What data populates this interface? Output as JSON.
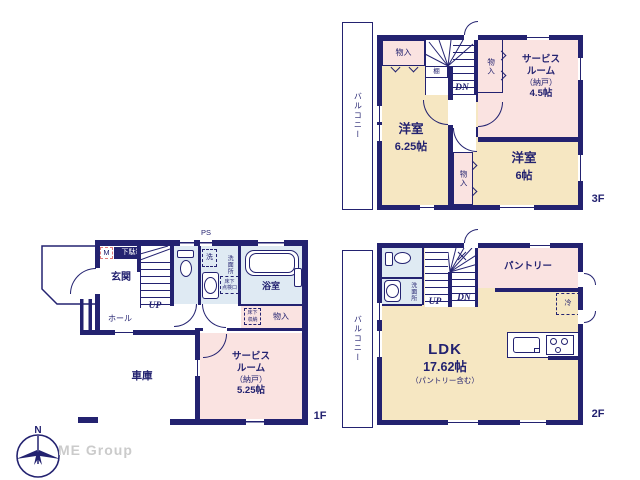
{
  "colors": {
    "wall_navy": "#232270",
    "room_cream": "#f6e7c2",
    "room_pink": "#fae3e1",
    "room_blue": "#dfeaf3",
    "watermark_gray": "#cbcbcb"
  },
  "watermark": "ME Group",
  "compass": {
    "north": "N"
  },
  "f3": {
    "tag": "3F",
    "balcony": "バルコニー",
    "closet_top": "物入",
    "shelf": "棚",
    "closet_mid": "物入",
    "closet_bottom": "物入",
    "dn": "DN",
    "service_room": {
      "line1": "サービス",
      "line2": "ルーム",
      "line3": "（納戸）",
      "line4": "4.5帖"
    },
    "room_a": {
      "name": "洋室",
      "size": "6.25帖"
    },
    "room_b": {
      "name": "洋室",
      "size": "6帖"
    }
  },
  "f2": {
    "tag": "2F",
    "balcony": "バルコニー",
    "washroom": "洗面所",
    "up": "UP",
    "dn": "DN",
    "pantry": "パントリー",
    "fridge": "冷",
    "ldk": {
      "name": "LDK",
      "size": "17.62帖",
      "note": "（パントリー含む）"
    }
  },
  "f1": {
    "tag": "1F",
    "ps": "PS",
    "meter": "M",
    "shoe_box": "下駄箱",
    "entrance": "玄関",
    "up": "UP",
    "laundry": "洗",
    "washroom": "洗面所",
    "hatch": {
      "line1": "床下",
      "line2": "点検口"
    },
    "bath": "浴室",
    "hall": "ホール",
    "floor_storage": {
      "line1": "床下",
      "line2": "収納"
    },
    "closet": "物入",
    "service_room": {
      "line1": "サービス",
      "line2": "ルーム",
      "line3": "（納戸）",
      "line4": "5.25帖"
    },
    "garage": "車庫"
  }
}
